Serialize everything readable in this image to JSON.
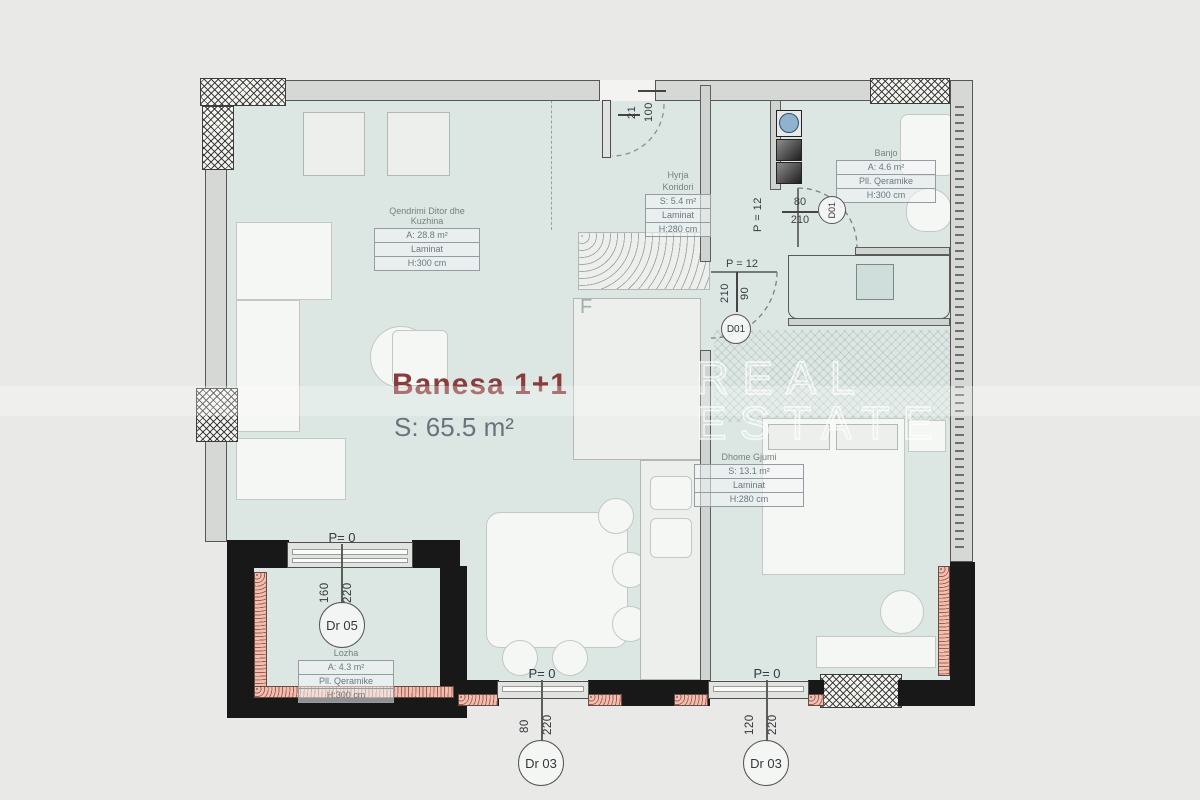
{
  "title": {
    "name": "Banesa 1+1",
    "area": "S: 65.5 m²"
  },
  "watermark": {
    "line1": "REAL",
    "line2": "ESTATE"
  },
  "rooms": {
    "living": {
      "name": "Qendrimi Ditor dhe Kuzhina",
      "rows": [
        "A: 28.8 m²",
        "Laminat",
        "H:300 cm"
      ]
    },
    "corridor": {
      "name1": "Hyrja",
      "name2": "Koridori",
      "rows": [
        "S: 5.4 m²",
        "Laminat",
        "H:280 cm"
      ]
    },
    "bath": {
      "name": "Banjo",
      "rows": [
        "A: 4.6 m²",
        "Pll. Qeramike",
        "H:300 cm"
      ]
    },
    "bedroom": {
      "name": "Dhome Gjumi",
      "rows": [
        "S: 13.1 m²",
        "Laminat",
        "H:280 cm"
      ]
    },
    "loggia": {
      "name": "Lozha",
      "rows": [
        "A: 4.3 m²",
        "Pll. Qeramike",
        "H:300 cm"
      ]
    }
  },
  "doors": {
    "entry": {
      "w": "100",
      "h": "21"
    },
    "bath": {
      "p": "P = 12",
      "w": "80",
      "h": "210",
      "tag": "D01"
    },
    "bedroom": {
      "p": "P = 12",
      "w": "90",
      "h": "210",
      "tag": "D01"
    },
    "balcony": {
      "p": "P= 0",
      "w": "160",
      "h": "220",
      "tag": "Dr 05"
    },
    "terrace_a": {
      "p": "P= 0",
      "w": "80",
      "h": "220",
      "tag": "Dr 03"
    },
    "terrace_b": {
      "p": "P= 0",
      "w": "120",
      "h": "220",
      "tag": "Dr 03"
    }
  },
  "kitchen": {
    "fridge_label": "F"
  },
  "colors": {
    "floor": "#dce7e4",
    "wall": "#d6d8d5",
    "black_wall": "#181818",
    "brick": "#eec0b2",
    "accent": "#8a3c3c",
    "area_text": "#6a737c"
  }
}
